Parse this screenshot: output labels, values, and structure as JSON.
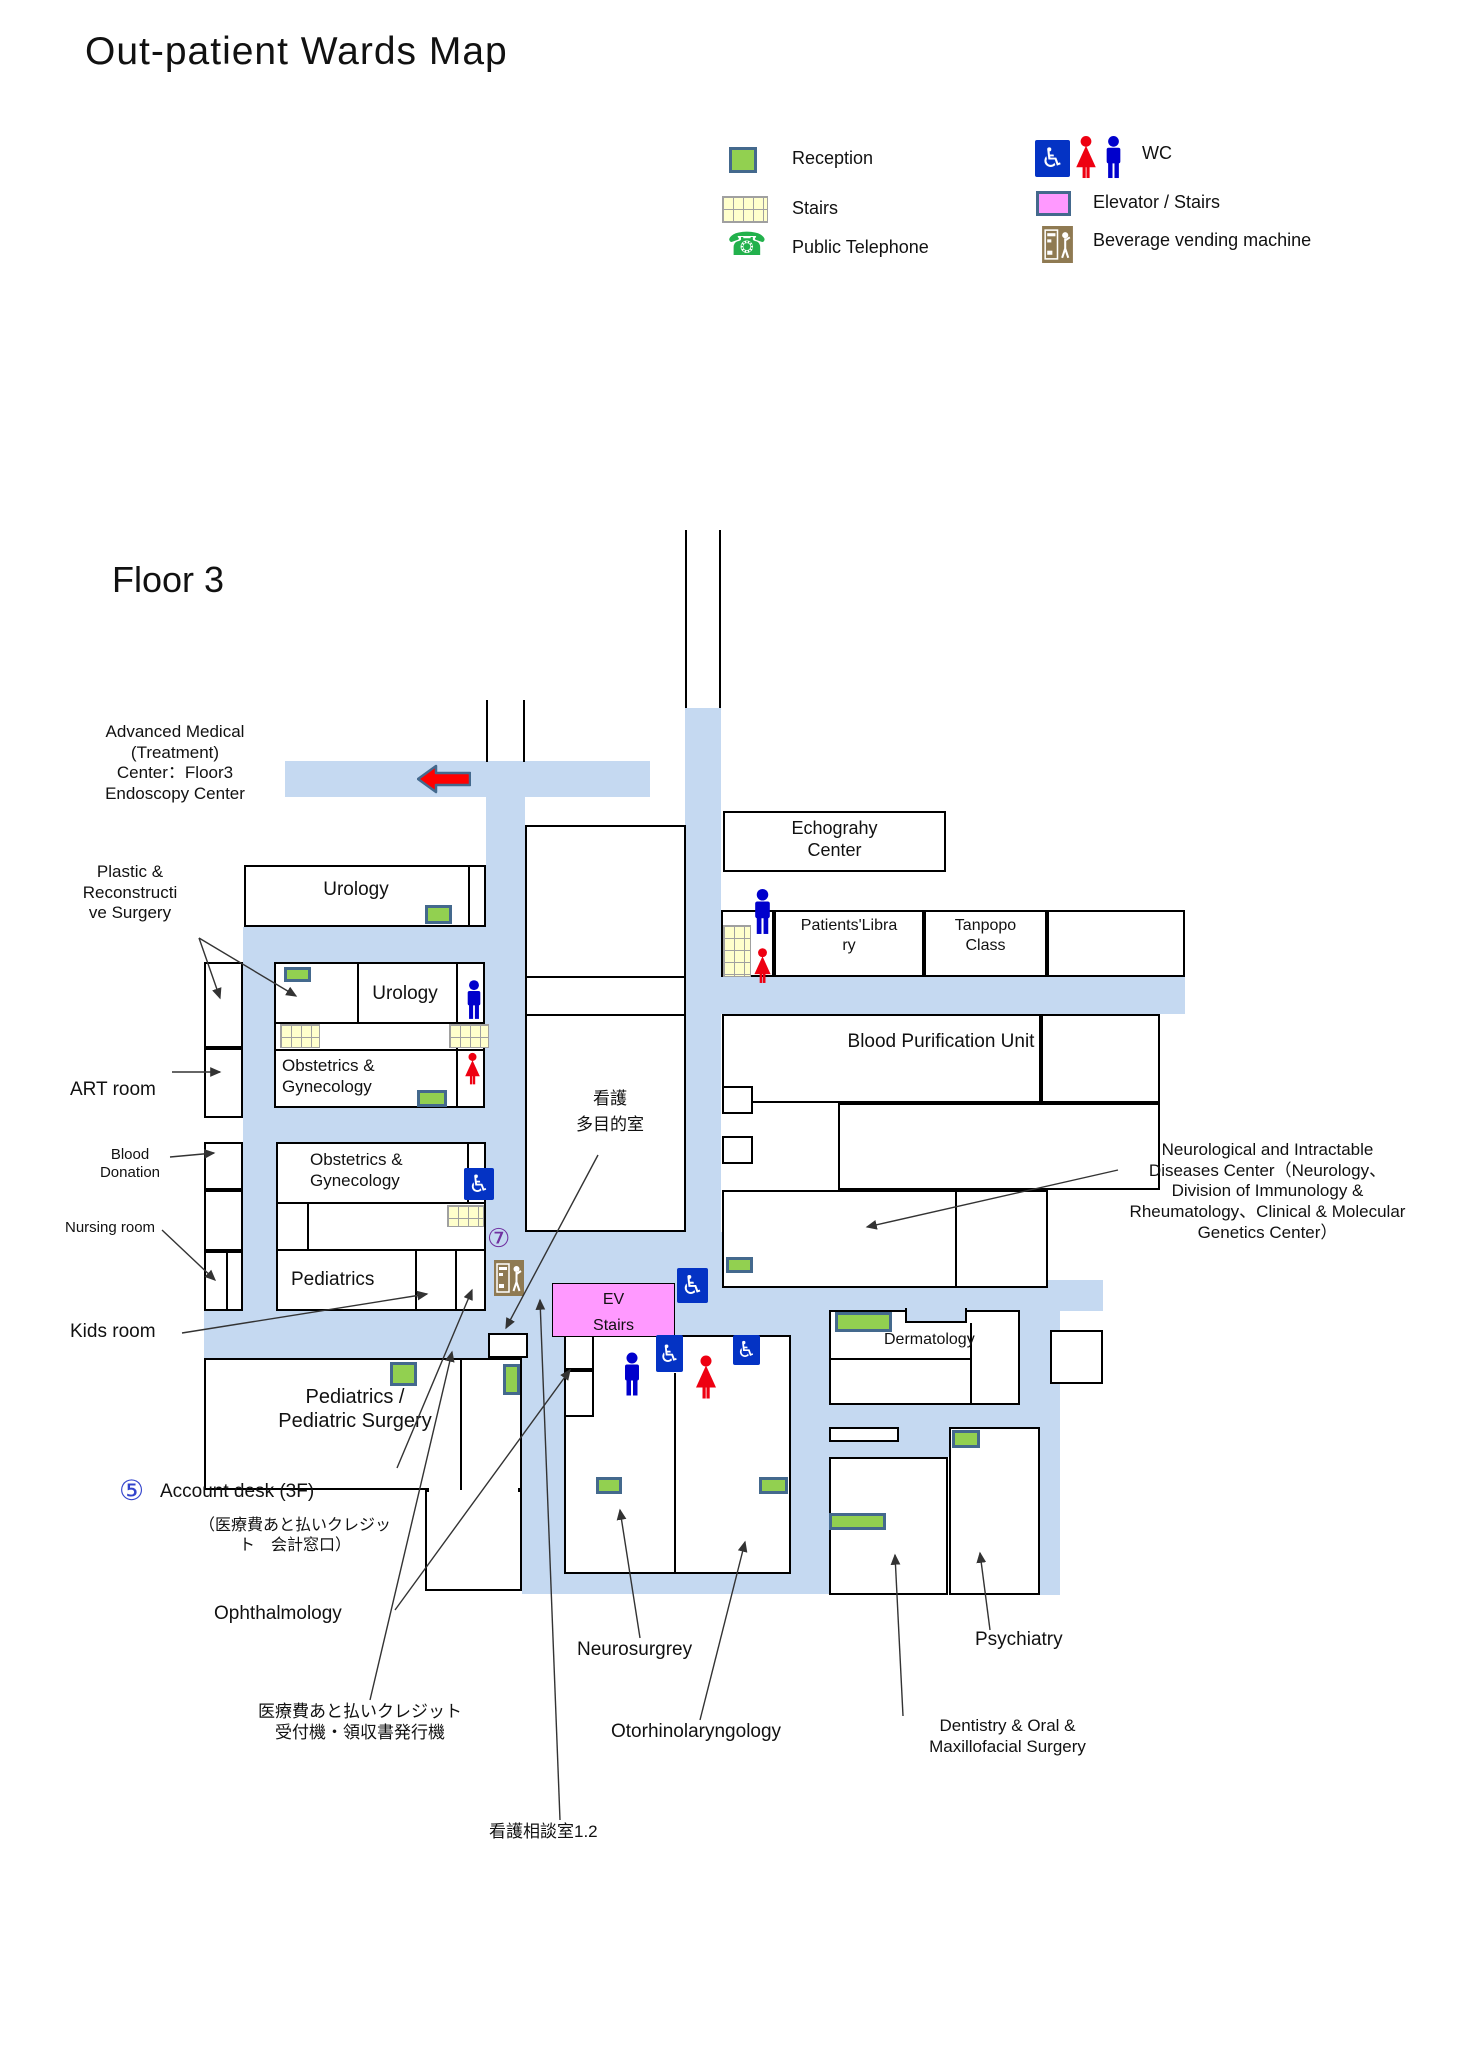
{
  "title": "Out-patient Wards Map",
  "floor_heading": "Floor 3",
  "legend": {
    "reception": "Reception",
    "stairs": "Stairs",
    "public_telephone": "Public Telephone",
    "wc": "WC",
    "elevator_stairs": "Elevator / Stairs",
    "vending": "Beverage vending machine"
  },
  "icons": {
    "phone_glyph": "☎",
    "wheelchair_glyph": "♿",
    "circle5": "⑤",
    "circle7": "⑦"
  },
  "colors": {
    "corridor": "#c5d9f1",
    "reception_fill": "#92d050",
    "reception_border": "#44698d",
    "stairs_fill": "#ffffcc",
    "elevator_pink": "#ff99ff",
    "wc_blue": "#0433c4",
    "man_blue": "#0000cc",
    "woman_red": "#ee0011",
    "vending_brown": "#8f7a52",
    "red_arrow": "#ff0000",
    "circle5_color": "#3344cc",
    "circle7_color": "#7030a0"
  },
  "rooms": {
    "urology_top": "Urology",
    "urology_inner": "Urology",
    "obgyn1": "Obstetrics &\nGynecology",
    "obgyn2": "Obstetrics &\nGynecology",
    "pediatrics": "Pediatrics",
    "ped_surgery": "Pediatrics /\nPediatric Surgery",
    "echography": "Echograhy\nCenter",
    "library": "Patients'Libra\nry",
    "tanpopo": "Tanpopo\nClass",
    "bpu": "Blood Purification Unit",
    "dermatology": "Dermatology",
    "ev": "EV\nStairs",
    "kango": "看護\n多目的室"
  },
  "labels": {
    "advanced": "Advanced Medical\n(Treatment)\nCenter：Floor3\nEndoscopy Center",
    "plastic": "Plastic &\nReconstructi\nve Surgery",
    "art": "ART room",
    "blood": "Blood\nDonation",
    "nursing": "Nursing room",
    "kids": "Kids room",
    "account": "Account desk (3F)",
    "account_sub": "（医療費あと払いクレジッ\nト　会計窓口）",
    "ophthalmology": "Ophthalmology",
    "credit_machine": "医療費あと払いクレジット\n受付機・領収書発行機",
    "nursing_consult": "看護相談室1.2",
    "neurosurgery": "Neurosurgrey",
    "otorhino": "Otorhinolaryngology",
    "dentistry": "Dentistry & Oral &\nMaxillofacial Surgery",
    "psychiatry": "Psychiatry",
    "neuro_center": "Neurological and Intractable\nDiseases Center（Neurology、\nDivision of Immunology &\nRheumatology、Clinical & Molecular\nGenetics Center）"
  }
}
